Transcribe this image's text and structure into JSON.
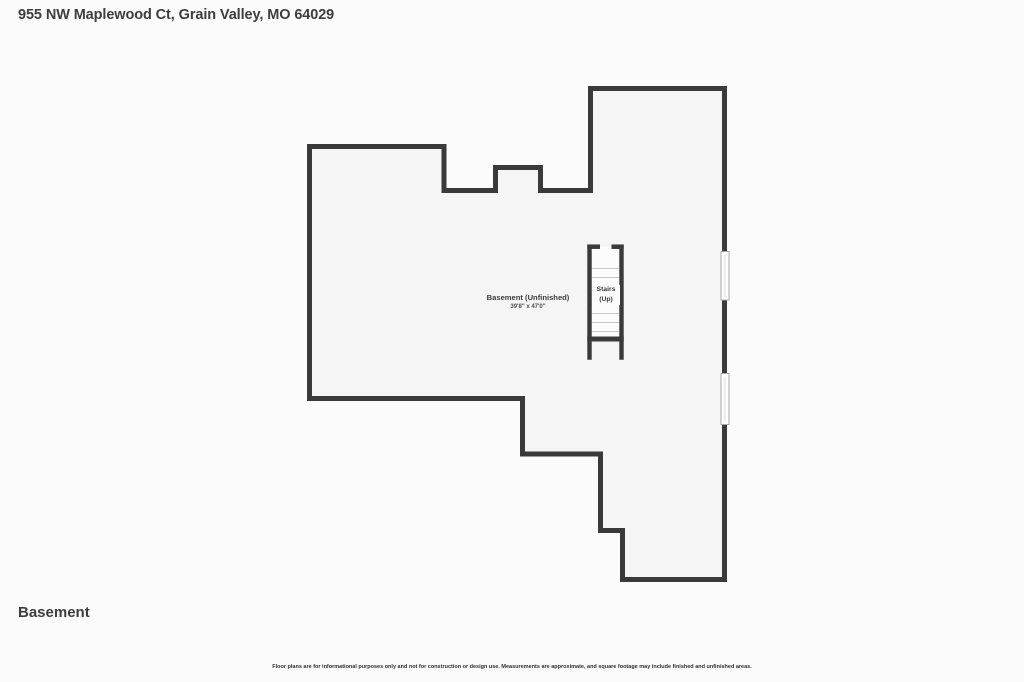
{
  "page": {
    "title": "955 NW Maplewood Ct, Grain Valley, MO 64029",
    "floor_label": "Basement",
    "disclaimer": "Floor plans are for informational purposes only and not for construction or design use. Measurements are approximate, and square footage may include finished and unfinished areas."
  },
  "floor_plan": {
    "wall_color": "#3a3a3a",
    "interior_color": "#f5f5f5",
    "background_color": "#fbfbfb",
    "room": {
      "name": "Basement (Unfinished)",
      "dimensions": "39'8\" x 47'0\""
    },
    "stairs": {
      "label_line1": "Stairs",
      "label_line2": "(Up)"
    }
  }
}
